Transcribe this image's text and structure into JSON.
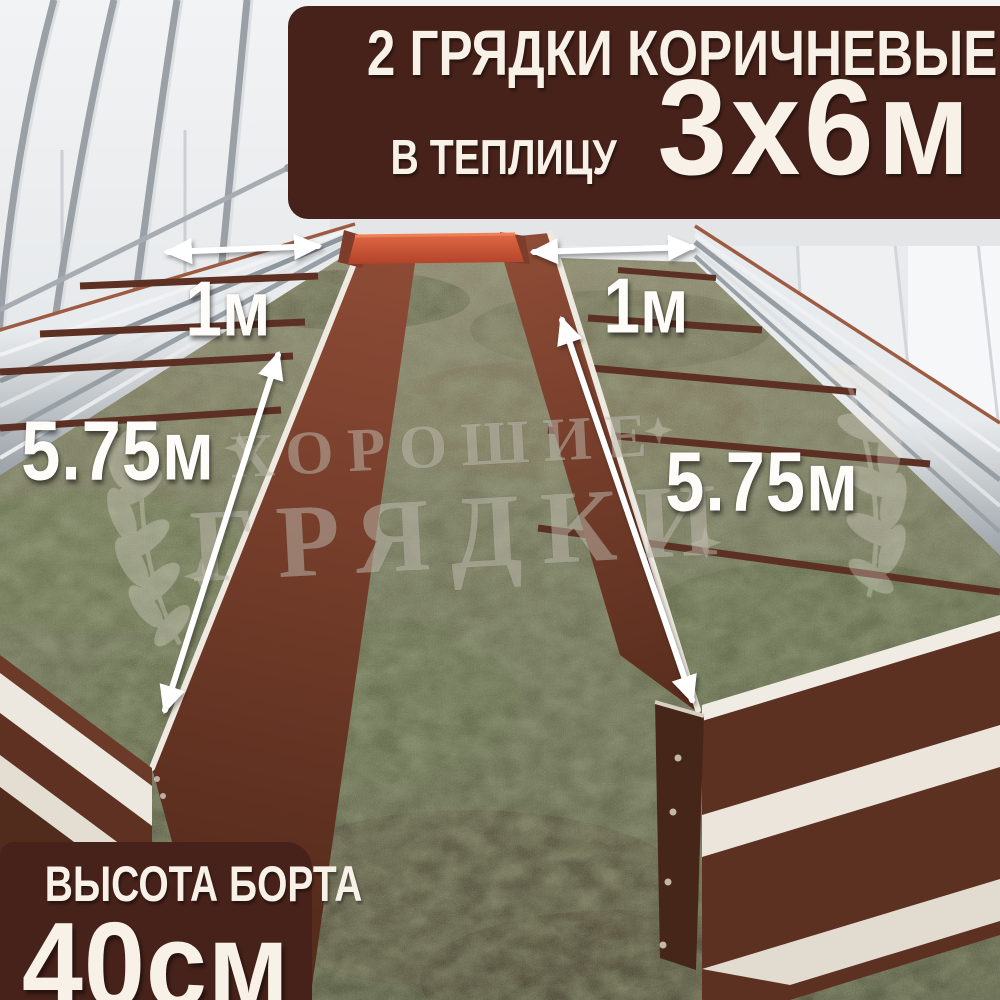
{
  "top_banner": {
    "line1": "2 ГРЯДКИ КОРИЧНЕВЫЕ",
    "line2_prefix": "В ТЕПЛИЦУ",
    "line2_size": "3х6м"
  },
  "bottom_banner": {
    "label": "ВЫСОТА БОРТА",
    "value": "40см"
  },
  "measurements": {
    "left_bed_width": "1м",
    "right_bed_width": "1м",
    "left_bed_length": "5.75м",
    "right_bed_length": "5.75м"
  },
  "watermark": {
    "line1": "ХОРОШИЕ",
    "line2": "ГРЯДКИ"
  },
  "colors": {
    "banner_brown": "#47221a",
    "text_cream": "#f7f1e7",
    "bed_brown": "#5e3122",
    "bed_orange": "#c85434",
    "galvanized_steel": "#c3c8cc",
    "arrow_white": "#ffffff"
  }
}
